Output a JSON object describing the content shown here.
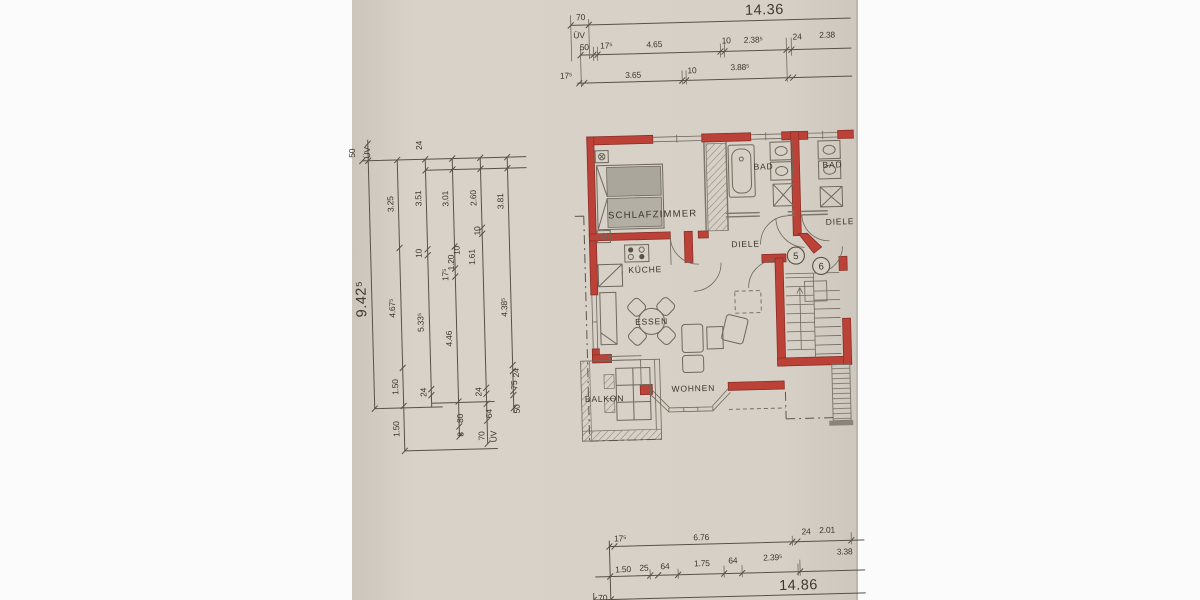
{
  "colors": {
    "paper": "#d7d1c7",
    "paper_edge": "#c2bcb2",
    "wall_red": "#bc4238",
    "wall_red_dark": "#8a2e27",
    "ink": "#575146"
  },
  "dims": {
    "top": {
      "overall": "14.36",
      "seg70": "70",
      "uv": "ÜV",
      "row2": [
        "50",
        "17⁵",
        "4.65",
        "10",
        "2.38⁵",
        "24",
        "2.38"
      ],
      "row3": [
        "17⁵",
        "3.65",
        "10",
        "3.88⁵"
      ]
    },
    "left": {
      "header": [
        "50",
        "ÜV",
        "24"
      ],
      "overall": "9.42⁵",
      "col2": [
        "3.25",
        "4.67⁵",
        "1.50",
        "1.50"
      ],
      "col3": [
        "3.51",
        "10",
        "5.33⁵",
        "24"
      ],
      "col4": [
        "3.01",
        "17⁵",
        "1.20",
        "10",
        "4.46",
        "80",
        "8"
      ],
      "col5": [
        "2.60",
        "10",
        "1.61",
        "24",
        "64",
        "70",
        "ÜV"
      ],
      "col6": [
        "3.81",
        "4.38⁵",
        "24",
        "75",
        "50"
      ]
    },
    "bottom": {
      "row1": [
        "17⁵",
        "6.76",
        "24",
        "2.01"
      ],
      "row2": [
        "1.50",
        "25",
        "64",
        "1.75",
        "64",
        "2.39⁵",
        "3.38"
      ],
      "overall": "14.86",
      "seg70": "70"
    }
  },
  "rooms": {
    "schlafzimmer": "SCHLAFZIMMER",
    "bad_left": "BAD",
    "bad_right": "BAD",
    "diele_left": "DIELE",
    "diele_right": "DIELE",
    "kueche": "KÜCHE",
    "essen": "ESSEN",
    "wohnen": "WOHNEN",
    "balkon": "BALKON"
  },
  "numbers": {
    "left": "5",
    "right": "6"
  }
}
